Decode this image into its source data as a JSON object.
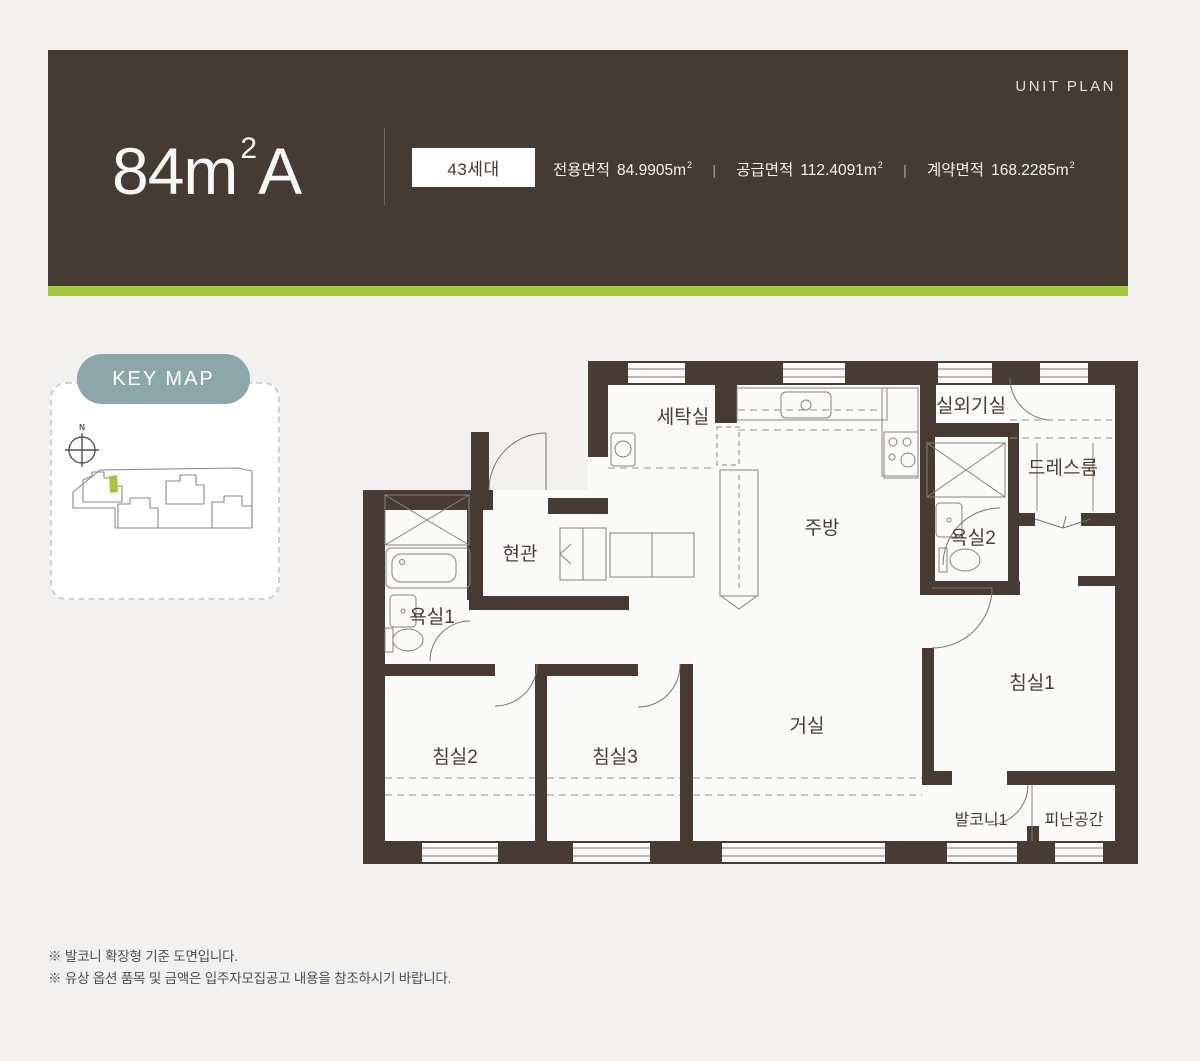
{
  "header": {
    "unit_plan_label": "UNIT PLAN",
    "title": {
      "main": "84m",
      "sup": "2",
      "suffix": "A"
    },
    "badge": "43세대",
    "separator": "|",
    "areas": [
      {
        "label": "전용면적",
        "value": "84.9905",
        "unit": "m",
        "unit_sup": "2"
      },
      {
        "label": "공급면적",
        "value": "112.4091",
        "unit": "m",
        "unit_sup": "2"
      },
      {
        "label": "계약면적",
        "value": "168.2285",
        "unit": "m",
        "unit_sup": "2"
      }
    ],
    "colors": {
      "bg": "#463b33",
      "accent_bar": "#a3c83f",
      "badge_bg": "#ffffff"
    }
  },
  "keymap": {
    "label": "KEY MAP",
    "compass_label": "N",
    "pill_color": "#8ca7aa",
    "highlight_color": "#a3c83f"
  },
  "floorplan": {
    "wall_color": "#473b33",
    "line_color": "#8b8177",
    "rooms": [
      {
        "id": "laundry",
        "label": "세탁실"
      },
      {
        "id": "outdoor-unit",
        "label": "실외기실"
      },
      {
        "id": "dressroom",
        "label": "드레스룸"
      },
      {
        "id": "entrance",
        "label": "현관"
      },
      {
        "id": "kitchen",
        "label": "주방"
      },
      {
        "id": "bath2",
        "label": "욕실2"
      },
      {
        "id": "bath1",
        "label": "욕실1"
      },
      {
        "id": "bedroom1",
        "label": "침실1"
      },
      {
        "id": "bedroom2",
        "label": "침실2"
      },
      {
        "id": "bedroom3",
        "label": "침실3"
      },
      {
        "id": "living",
        "label": "거실"
      },
      {
        "id": "balcony1",
        "label": "발코니1"
      },
      {
        "id": "refuge",
        "label": "피난공간"
      }
    ]
  },
  "notes": [
    "※ 발코니 확장형 기준 도면입니다.",
    "※ 유상 옵션 품목 및 금액은 입주자모집공고 내용을 참조하시기 바랍니다."
  ]
}
